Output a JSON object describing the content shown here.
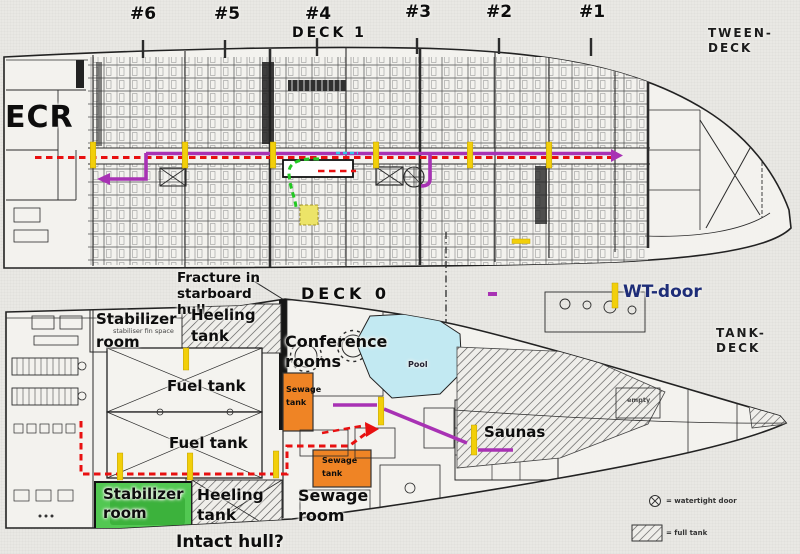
{
  "frames": {
    "f6": "#6",
    "f5": "#5",
    "f4": "#4",
    "f3": "#3",
    "f2": "#2",
    "f1": "#1"
  },
  "deck1": {
    "title": "DECK 1",
    "side_label": "TWEEN-DECK",
    "ecr": "ECR"
  },
  "notes": {
    "fracture": "Fracture in starboard hull",
    "wt_door": "WT-door",
    "intact_hull": "Intact hull?"
  },
  "deck0": {
    "title": "DECK 0",
    "side_label": "TANK-DECK",
    "stabilizer_room_top": "Stabilizer room",
    "stabilizer_room_sub": "stabiliser fin space",
    "heeling_tank_top": "Heeling tank",
    "conference_rooms": "Conference rooms",
    "pool": "Pool",
    "fuel_tank_upper": "Fuel tank",
    "fuel_tank_lower": "Fuel tank",
    "sewage_tank_upper": "Sewage tank",
    "sewage_tank_lower": "Sewage tank",
    "saunas": "Saunas",
    "sewage_room": "Sewage room",
    "stabilizer_room_bottom": "Stabilizer room",
    "heeling_tank_bottom": "Heeling tank",
    "empty_room": "empty"
  },
  "legend": {
    "watertight_door": "= watertight door",
    "full_tank": "= full tank"
  },
  "colors": {
    "escape_route_red": "#e81010",
    "route_magenta": "#a832b4",
    "route_green": "#22c822",
    "route_cyan": "#35c5e8",
    "wt_door_yellow": "#f2cf0a",
    "sewage_orange": "#ef8425",
    "stabilizer_green": "#52c852",
    "pool_blue": "#c2e9f2",
    "wt_door_text": "#1e2d78"
  }
}
